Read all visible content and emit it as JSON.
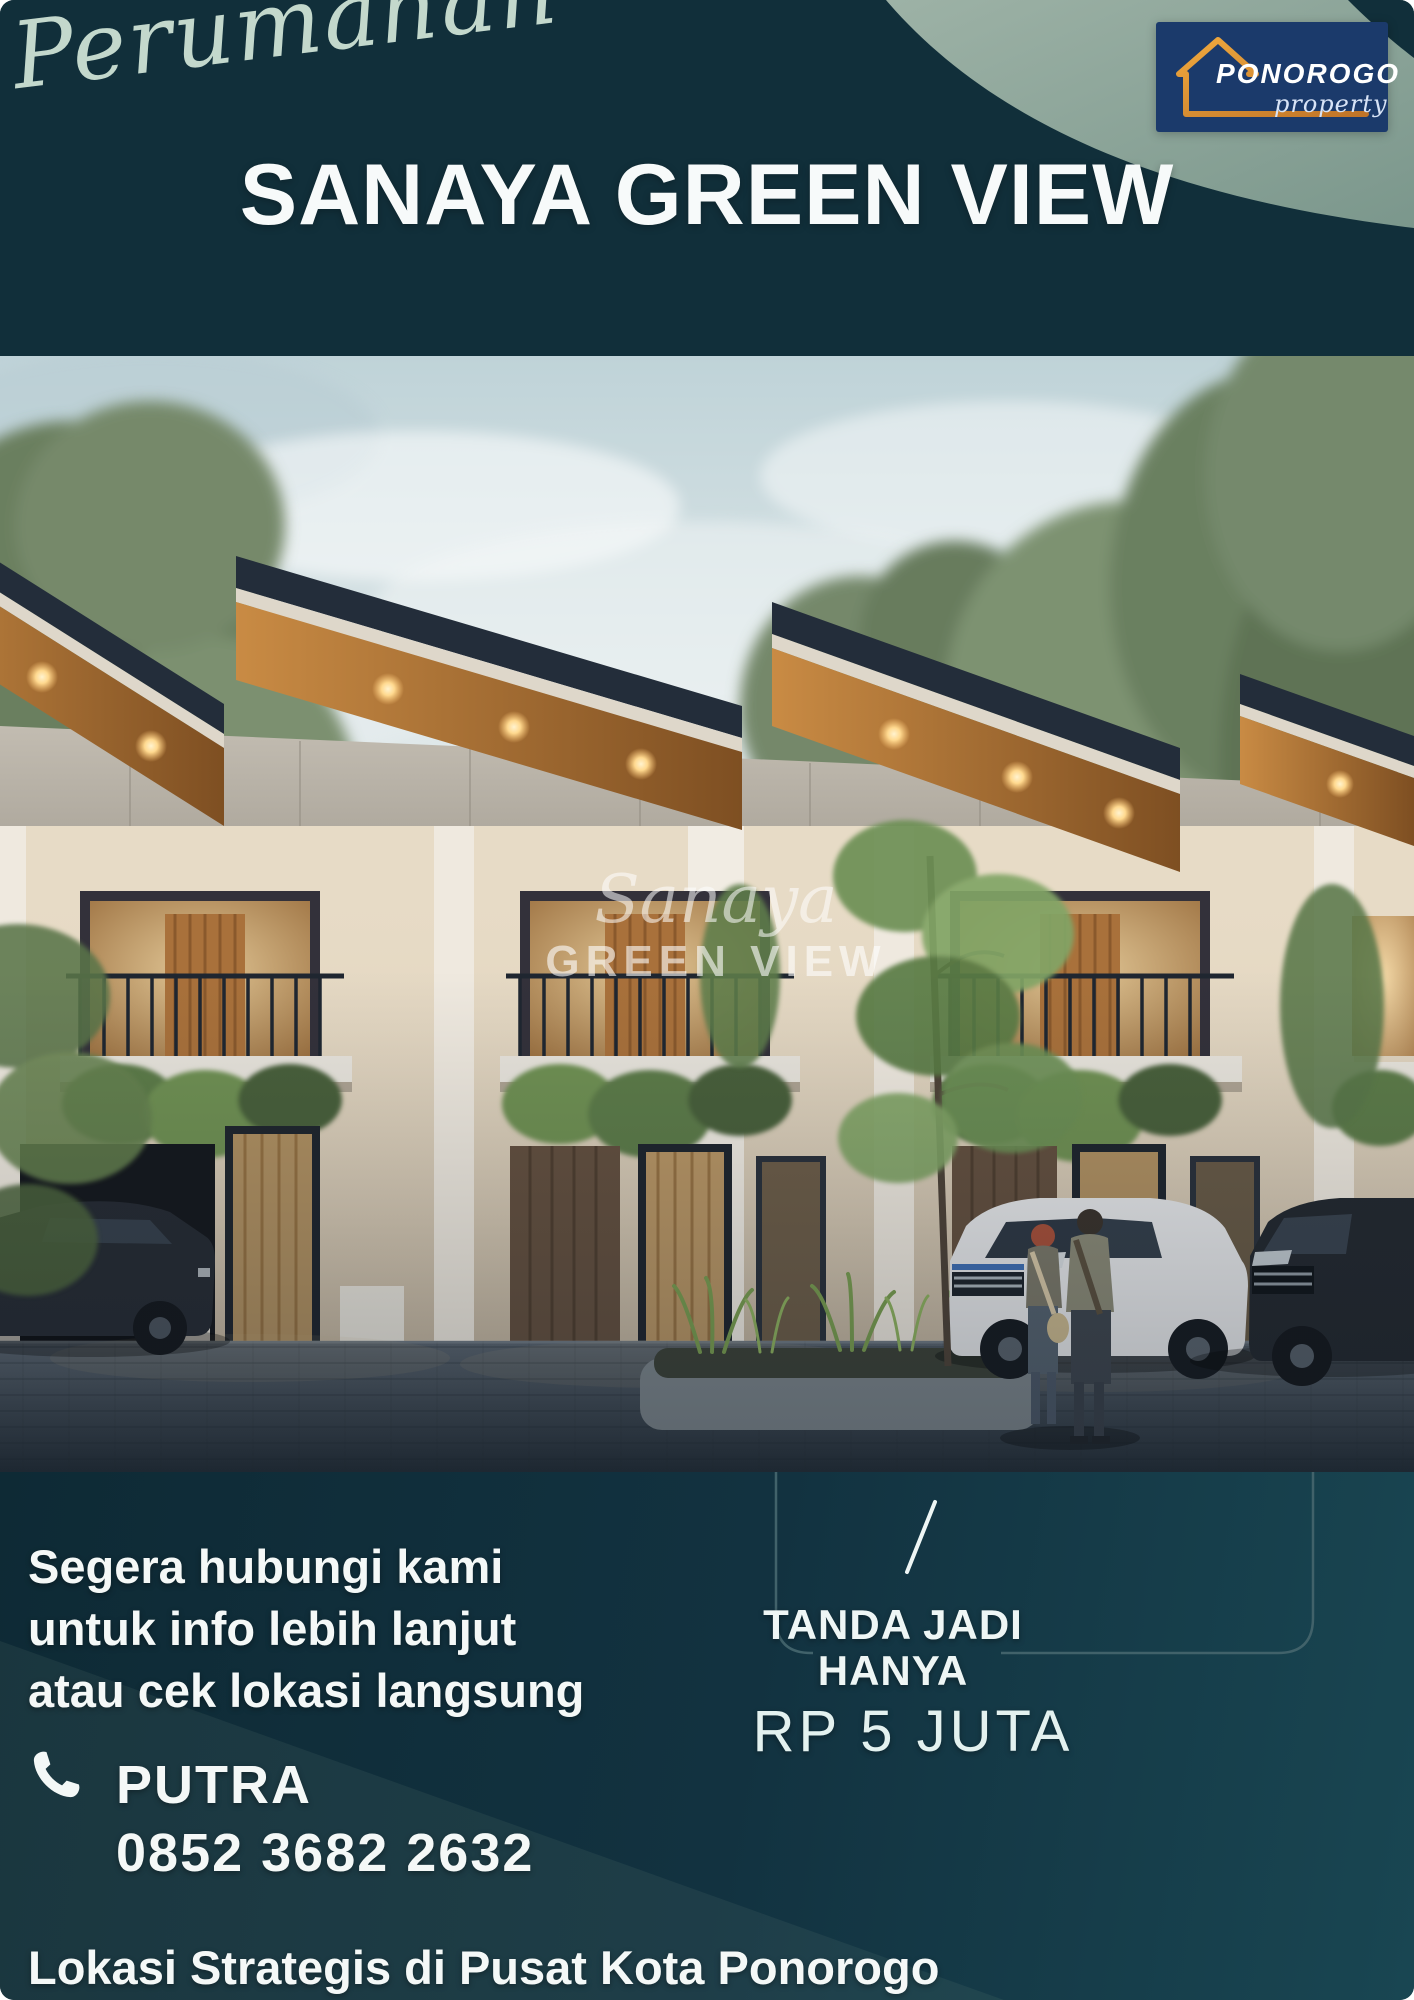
{
  "header": {
    "script_label": "Perumahan",
    "title": "SANAYA GREEN VIEW",
    "logo": {
      "name": "PONOROGO",
      "sub": "property"
    }
  },
  "photo": {
    "watermark_script": "Sanaya",
    "watermark_caps": "GREEN VIEW"
  },
  "contact": {
    "line1": "Segera hubungi kami",
    "line2": "untuk info lebih lanjut",
    "line3": "atau cek lokasi langsung",
    "person": "PUTRA",
    "phone": "0852 3682 2632"
  },
  "offer": {
    "line1": "TANDA JADI",
    "line2": "HANYA",
    "price": "RP 5 JUTA"
  },
  "footer": {
    "text": "Lokasi Strategis di Pusat Kota Ponorogo"
  },
  "colors": {
    "teal_dark": "#112f3a",
    "teal_deep": "#0d2733",
    "sage": "#829c91",
    "sage_light": "#c3d8cc",
    "logo_navy": "#1b3a6b",
    "logo_orange": "#e09b3d",
    "text_light": "#f4f8f7",
    "wood_soffit": "#b87a3c",
    "warm_glow": "#ffd9a0"
  }
}
